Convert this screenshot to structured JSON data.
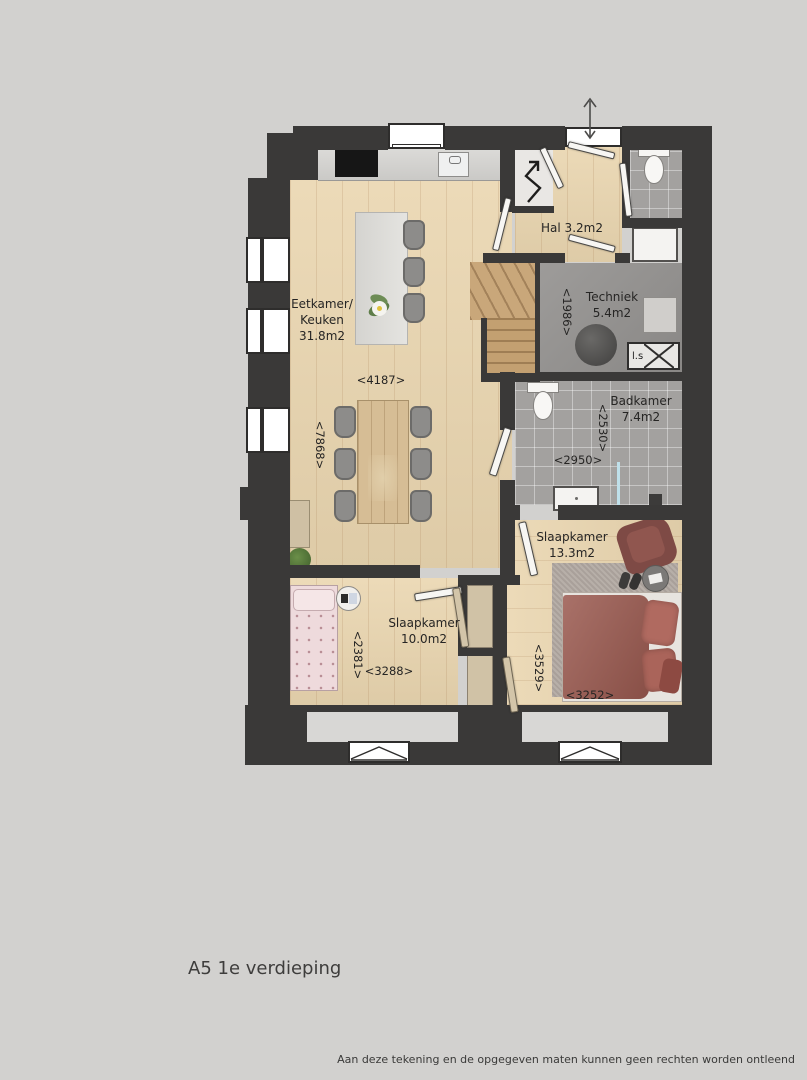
{
  "plan": {
    "title": "A5 1e verdieping",
    "disclaimer": "Aan deze tekening en de opgegeven maten kunnen geen rechten worden ontleend"
  },
  "rooms": {
    "eetkamer": {
      "line1": "Eetkamer/",
      "line2": "Keuken",
      "area": "31.8m2",
      "dim_w": "<4187>",
      "dim_h": "<7868>"
    },
    "hal": {
      "label": "Hal 3.2m2"
    },
    "techniek": {
      "name": "Techniek",
      "area": "5.4m2",
      "dim_h": "<1986>"
    },
    "badkamer": {
      "name": "Badkamer",
      "area": "7.4m2",
      "dim_h": "<2530>",
      "dim_w": "<2950>"
    },
    "slaapkamer_groot": {
      "name": "Slaapkamer",
      "area": "13.3m2",
      "dim_h": "<3529>",
      "dim_w": "<3252>"
    },
    "slaapkamer_klein": {
      "name": "Slaapkamer",
      "area": "10.0m2",
      "dim_h": "<2381>",
      "dim_w": "<3288>"
    }
  },
  "annotations": {
    "shaft": "l.s"
  },
  "colors": {
    "background": "#d2d1cf",
    "wall": "#3a3938",
    "wood_floor": "#ead6b0",
    "tile_floor": "#a3a19f",
    "stairs": "#c9a77a",
    "bed_double": "#9b5a50",
    "bed_single": "#eedadc",
    "rug": "#b2a9a2"
  }
}
